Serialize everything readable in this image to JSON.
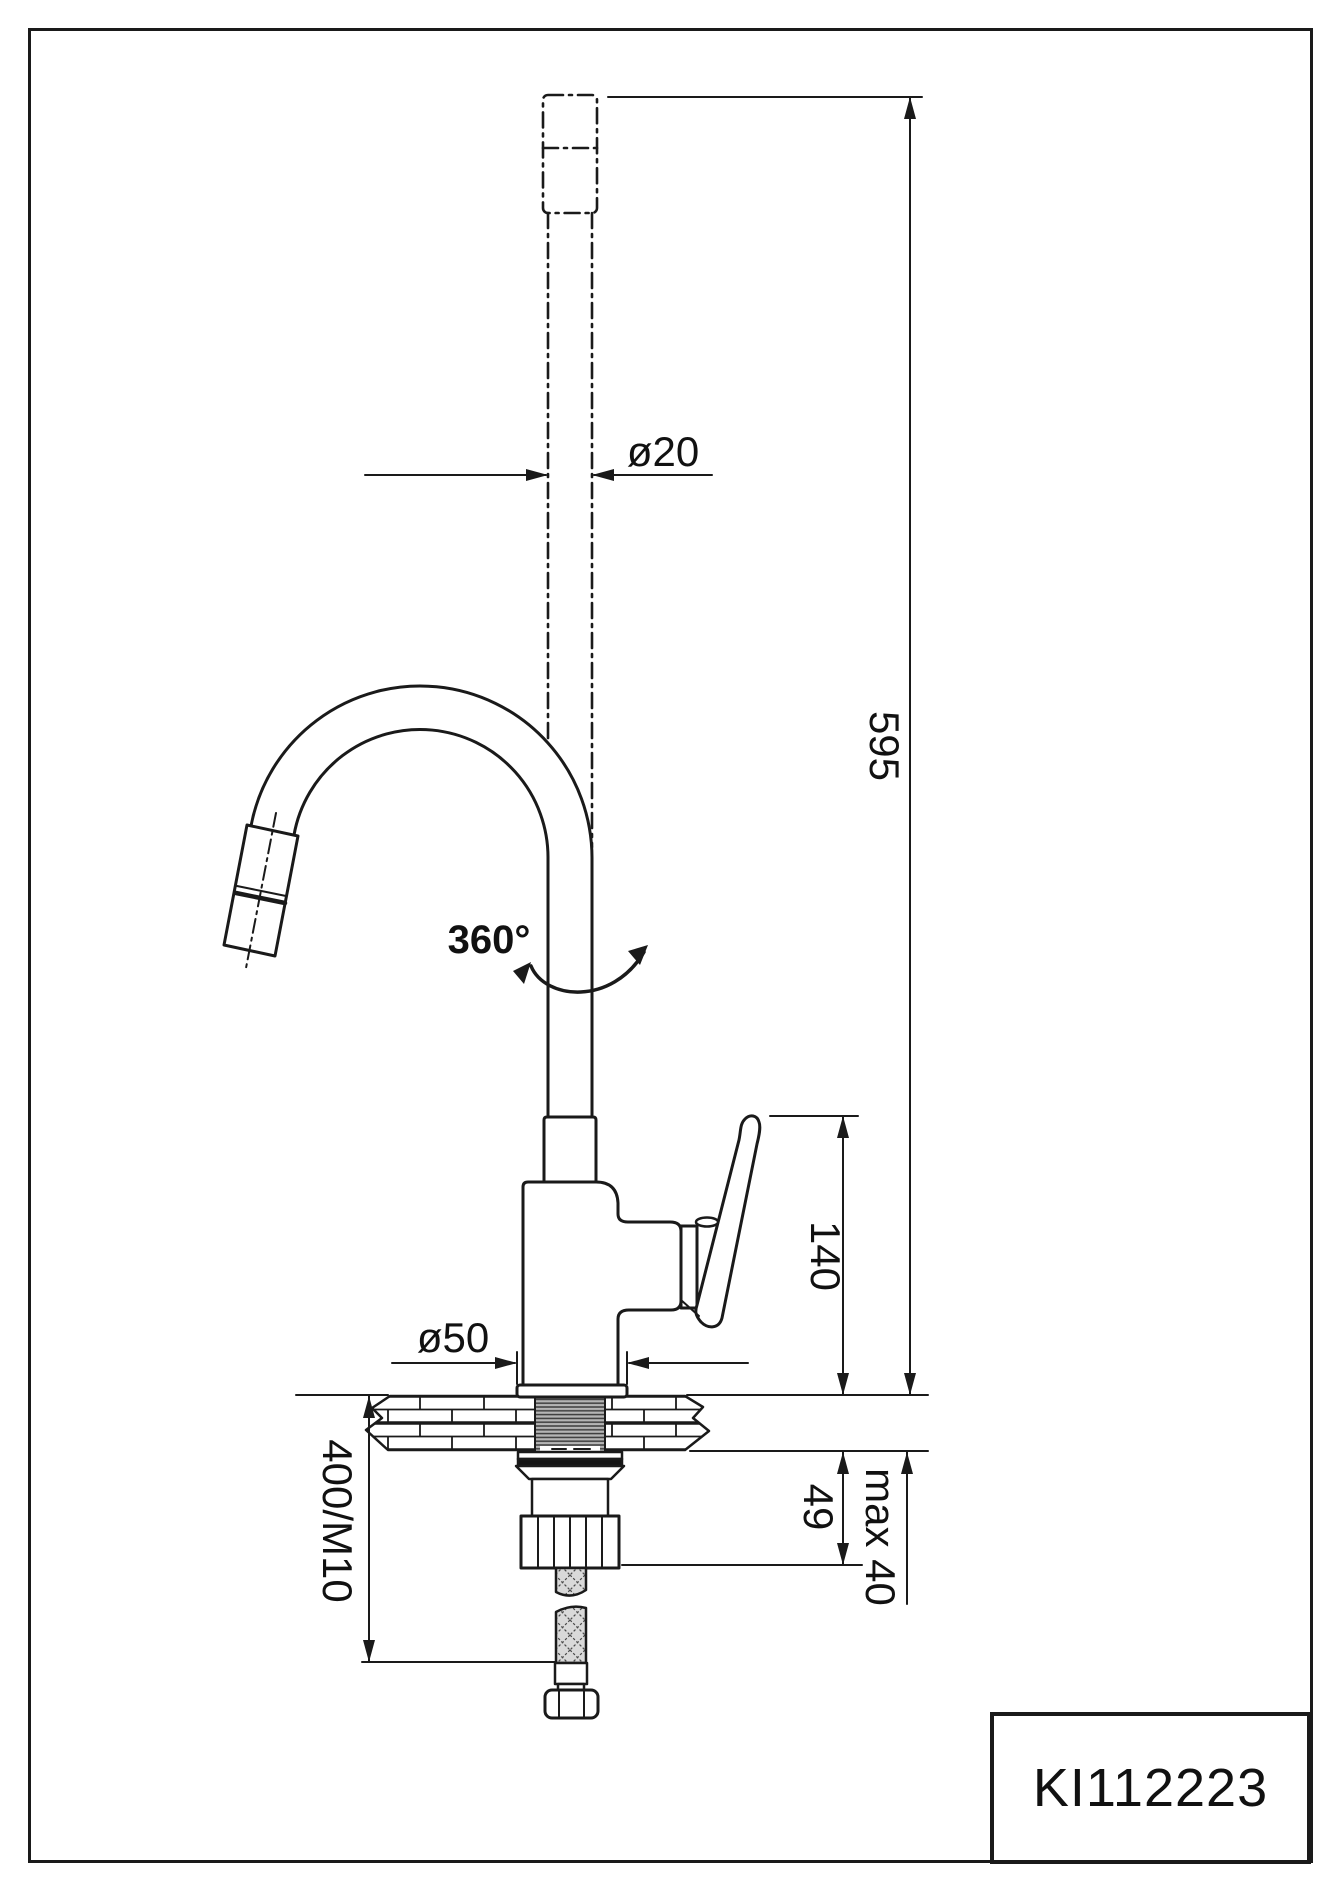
{
  "drawing": {
    "product_code": "KI112223",
    "labels": {
      "pipe_diameter": "ø20",
      "total_height": "595",
      "swivel_angle": "360°",
      "height_to_handle": "140",
      "base_diameter": "ø50",
      "underdeck_fitting_height": "49",
      "countertop_max_thickness": "max 40",
      "supply_hose": "400/M10"
    },
    "colors": {
      "line": "#1a1a1a",
      "background": "#ffffff",
      "shank_gray": "#b5b5b5",
      "hose_gray": "#d9d9d9"
    }
  }
}
